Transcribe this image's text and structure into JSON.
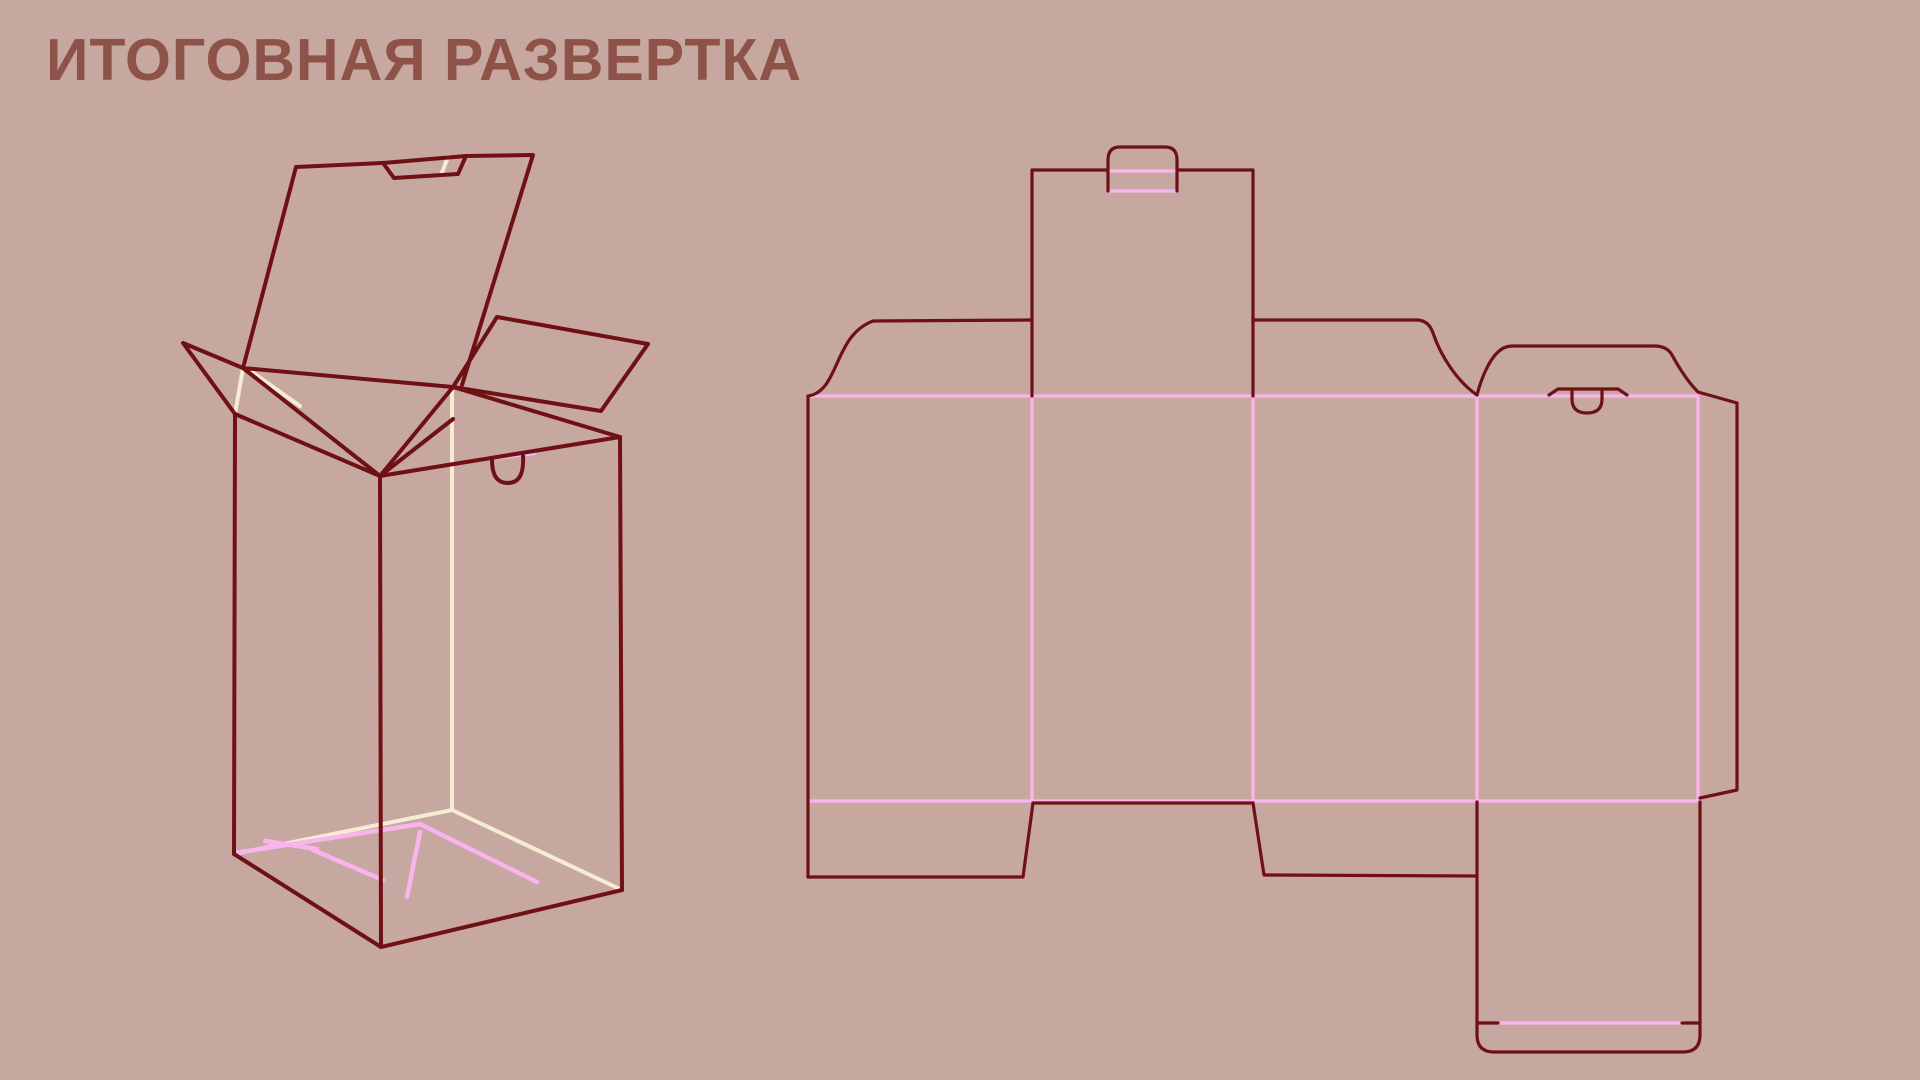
{
  "title": "ИТОГОВНАЯ РАЗВЕРТКА",
  "colors": {
    "background": "#c7a8a1",
    "cut_line": "#6f1015",
    "fold_line": "#f9b4ee",
    "hidden_edge": "#f6ecd2",
    "title_text": "#8d5348"
  },
  "figures": {
    "left": "3d-preview-of-open-tuck-box",
    "right": "flat-dieline-of-tuck-box",
    "legend": {
      "dark_lines": "cut edges",
      "pink_lines": "fold / crease lines",
      "cream_lines": "hidden edges"
    }
  }
}
